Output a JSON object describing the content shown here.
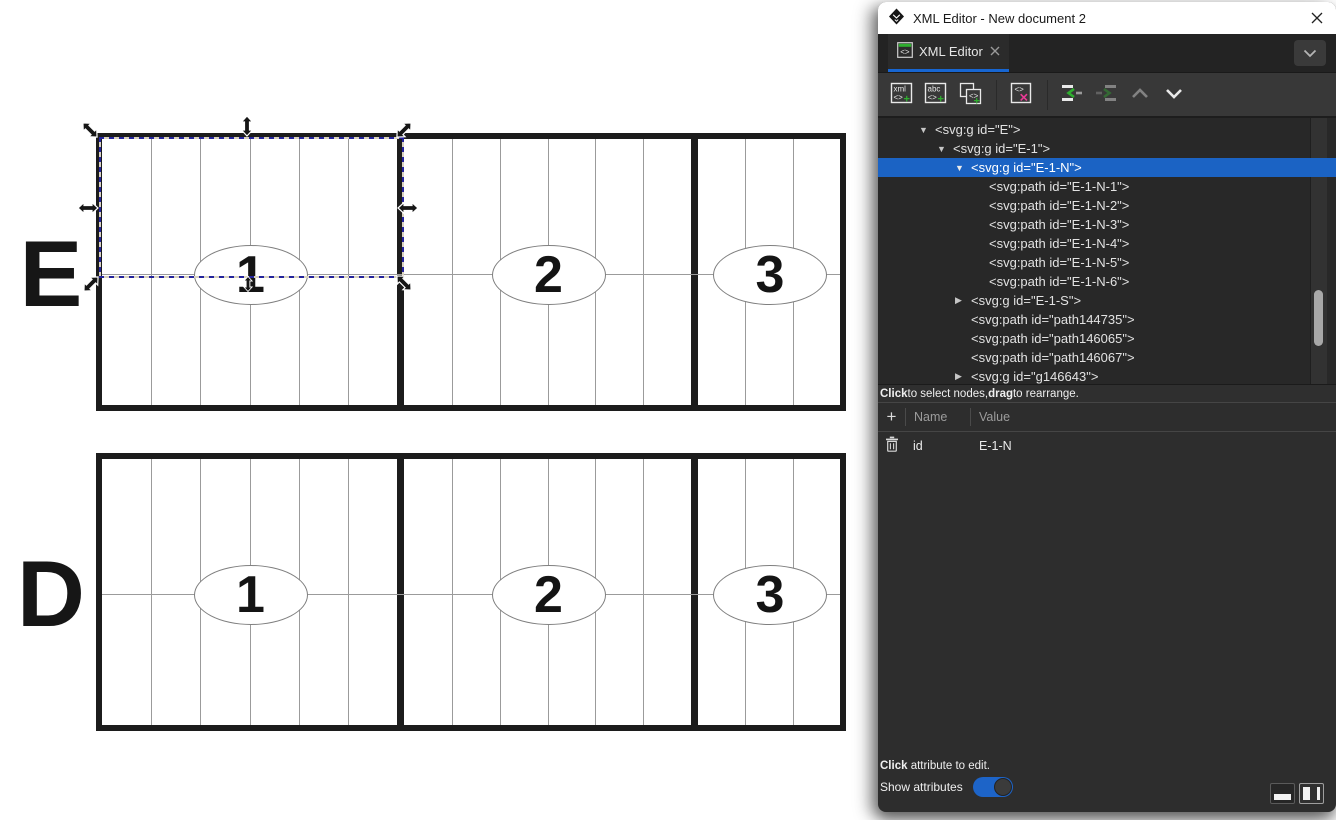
{
  "window": {
    "title": "XML Editor - New document 2"
  },
  "tab": {
    "label": "XML Editor"
  },
  "colors": {
    "accent_blue": "#1b63c4",
    "underline_blue": "#1766d2",
    "green": "#2fae2f",
    "pink": "#ea3a96"
  },
  "toolbar": {
    "buttons": [
      {
        "name": "new-element-node-button",
        "icon": "new-element-node-icon",
        "glyph_top": "xml",
        "glyph_tag": "<>",
        "glyph_plus": "+",
        "enabled": true
      },
      {
        "name": "new-text-node-button",
        "icon": "new-text-node-icon",
        "glyph_top": "abc",
        "glyph_tag": "<>",
        "glyph_plus": "+",
        "enabled": true
      },
      {
        "name": "duplicate-node-button",
        "icon": "duplicate-node-icon",
        "glyph_tag": "<>",
        "glyph_plus": "+",
        "enabled": true
      },
      {
        "name": "delete-node-button",
        "icon": "delete-node-icon",
        "glyph_tag": "<>",
        "glyph_x": "✕",
        "enabled": true,
        "sep_before": true
      },
      {
        "name": "unindent-node-button",
        "icon": "unindent-node-icon",
        "enabled": true,
        "sep_before": true
      },
      {
        "name": "indent-node-button",
        "icon": "indent-node-icon",
        "enabled": false
      },
      {
        "name": "move-node-up-button",
        "icon": "chevron-up-icon",
        "enabled": false
      },
      {
        "name": "move-node-down-button",
        "icon": "chevron-down-icon",
        "enabled": true
      }
    ]
  },
  "tree": {
    "rows": [
      {
        "text": "<svg:g id=\"E\">",
        "depth": 0,
        "expander": "expanded",
        "selected": false
      },
      {
        "text": "<svg:g id=\"E-1\">",
        "depth": 1,
        "expander": "expanded",
        "selected": false
      },
      {
        "text": "<svg:g id=\"E-1-N\">",
        "depth": 2,
        "expander": "expanded",
        "selected": true
      },
      {
        "text": "<svg:path id=\"E-1-N-1\">",
        "depth": 3,
        "expander": "none",
        "selected": false
      },
      {
        "text": "<svg:path id=\"E-1-N-2\">",
        "depth": 3,
        "expander": "none",
        "selected": false
      },
      {
        "text": "<svg:path id=\"E-1-N-3\">",
        "depth": 3,
        "expander": "none",
        "selected": false
      },
      {
        "text": "<svg:path id=\"E-1-N-4\">",
        "depth": 3,
        "expander": "none",
        "selected": false
      },
      {
        "text": "<svg:path id=\"E-1-N-5\">",
        "depth": 3,
        "expander": "none",
        "selected": false
      },
      {
        "text": "<svg:path id=\"E-1-N-6\">",
        "depth": 3,
        "expander": "none",
        "selected": false
      },
      {
        "text": "<svg:g id=\"E-1-S\">",
        "depth": 2,
        "expander": "collapsed",
        "selected": false
      },
      {
        "text": "<svg:path id=\"path144735\">",
        "depth": 2,
        "expander": "none",
        "selected": false
      },
      {
        "text": "<svg:path id=\"path146065\">",
        "depth": 2,
        "expander": "none",
        "selected": false
      },
      {
        "text": "<svg:path id=\"path146067\">",
        "depth": 2,
        "expander": "none",
        "selected": false
      },
      {
        "text": "<svg:g id=\"g146643\">",
        "depth": 2,
        "expander": "collapsed",
        "selected": false
      }
    ],
    "hint_parts": [
      {
        "text": "Click",
        "bold": true
      },
      {
        "text": " to select nodes, ",
        "bold": false
      },
      {
        "text": "drag",
        "bold": true
      },
      {
        "text": " to rearrange.",
        "bold": false
      }
    ]
  },
  "attributes": {
    "add_glyph": "+",
    "header": {
      "name": "Name",
      "value": "Value"
    },
    "rows": [
      {
        "name": "id",
        "value": "E-1-N"
      }
    ]
  },
  "footer": {
    "hint_parts": [
      {
        "text": "Click",
        "bold": true
      },
      {
        "text": " attribute to edit.",
        "bold": false
      }
    ],
    "show_attributes_label": "Show attributes",
    "show_attributes_on": true
  },
  "canvas": {
    "rows": [
      {
        "label": "E",
        "sections": [
          {
            "label": "1",
            "columns": 6
          },
          {
            "label": "2",
            "columns": 6
          },
          {
            "label": "3",
            "columns": 3
          }
        ]
      },
      {
        "label": "D",
        "sections": [
          {
            "label": "1",
            "columns": 6
          },
          {
            "label": "2",
            "columns": 6
          },
          {
            "label": "3",
            "columns": 3
          }
        ]
      }
    ],
    "selection": {
      "visible": true
    }
  }
}
